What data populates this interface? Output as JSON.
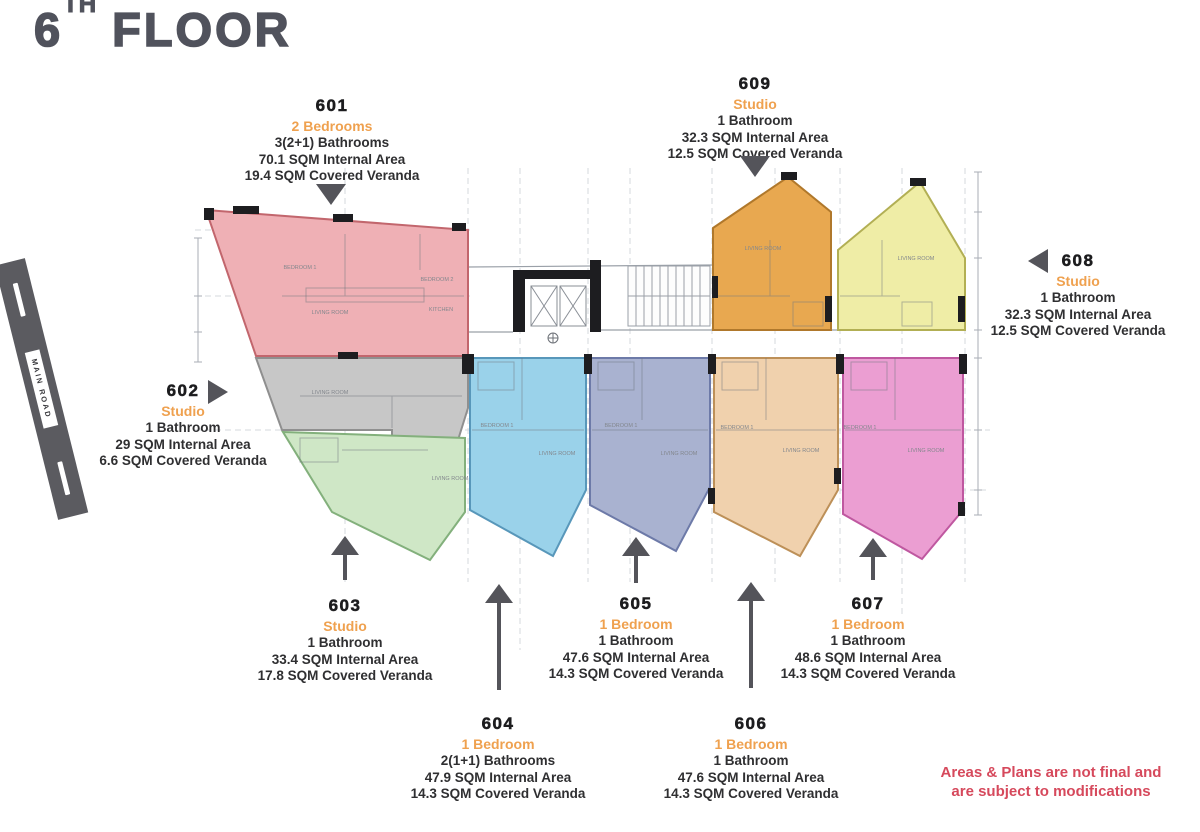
{
  "title": {
    "pre": "6",
    "sup": "TH",
    "rest": "FLOOR"
  },
  "main_road": "MAIN ROAD",
  "disclaimer": [
    "Areas & Plans are not final and",
    "are subject to modifications"
  ],
  "units": [
    {
      "id": "601",
      "type": "2 Bedrooms",
      "bath": "3(2+1) Bathrooms",
      "internal": "70.1 SQM Internal Area",
      "veranda": "19.4 SQM Covered Veranda",
      "color": "#efb0b5",
      "border": "#c2666d",
      "arrow": "down"
    },
    {
      "id": "602",
      "type": "Studio",
      "bath": "1 Bathroom",
      "internal": "29 SQM Internal Area",
      "veranda": "6.6 SQM Covered Veranda",
      "color": "#c7c7c7",
      "border": "#8f8f8f",
      "arrow": "right"
    },
    {
      "id": "603",
      "type": "Studio",
      "bath": "1 Bathroom",
      "internal": "33.4 SQM Internal Area",
      "veranda": "17.8 SQM Covered Veranda",
      "color": "#cfe7c6",
      "border": "#83b07c",
      "arrow": "up"
    },
    {
      "id": "604",
      "type": "1 Bedroom",
      "bath": "2(1+1) Bathrooms",
      "internal": "47.9 SQM Internal Area",
      "veranda": "14.3 SQM Covered Veranda",
      "color": "#9ad2ea",
      "border": "#5897ba",
      "arrow": "up"
    },
    {
      "id": "605",
      "type": "1 Bedroom",
      "bath": "1 Bathroom",
      "internal": "47.6 SQM Internal Area",
      "veranda": "14.3 SQM Covered Veranda",
      "color": "#a9b2d0",
      "border": "#6d7aa8",
      "arrow": "up"
    },
    {
      "id": "606",
      "type": "1 Bedroom",
      "bath": "1 Bathroom",
      "internal": "47.6 SQM Internal Area",
      "veranda": "14.3 SQM Covered Veranda",
      "color": "#f0d1ad",
      "border": "#bd9058",
      "arrow": "up"
    },
    {
      "id": "607",
      "type": "1 Bedroom",
      "bath": "1 Bathroom",
      "internal": "48.6 SQM Internal Area",
      "veranda": "14.3 SQM Covered Veranda",
      "color": "#eb9ed2",
      "border": "#bf58a0",
      "arrow": "up"
    },
    {
      "id": "608",
      "type": "Studio",
      "bath": "1 Bathroom",
      "internal": "32.3 SQM Internal Area",
      "veranda": "12.5 SQM Covered Veranda",
      "color": "#efeda6",
      "border": "#b2af54",
      "arrow": "left"
    },
    {
      "id": "609",
      "type": "Studio",
      "bath": "1 Bathroom",
      "internal": "32.3 SQM Internal Area",
      "veranda": "12.5 SQM Covered Veranda",
      "color": "#e8a850",
      "border": "#b0782b",
      "arrow": "down"
    }
  ],
  "plan": {
    "room_labels": [
      "BEDROOM 1",
      "BEDROOM 2",
      "LIVING ROOM",
      "KITCHEN",
      "LIVING ROOM",
      "LIVING ROOM",
      "BEDROOM 1",
      "LIVING ROOM",
      "BEDROOM 1",
      "LIVING ROOM",
      "BEDROOM 1",
      "LIVING ROOM",
      "BEDROOM 1",
      "LIVING ROOM",
      "LIVING ROOM",
      "LIVING ROOM"
    ]
  },
  "colors": {
    "accent_orange": "#efa14f",
    "text_dark": "#2f2f31",
    "disclaimer": "#d6495c",
    "arrow": "#54545a",
    "road": "#5b5b60",
    "title": "#50525c"
  }
}
